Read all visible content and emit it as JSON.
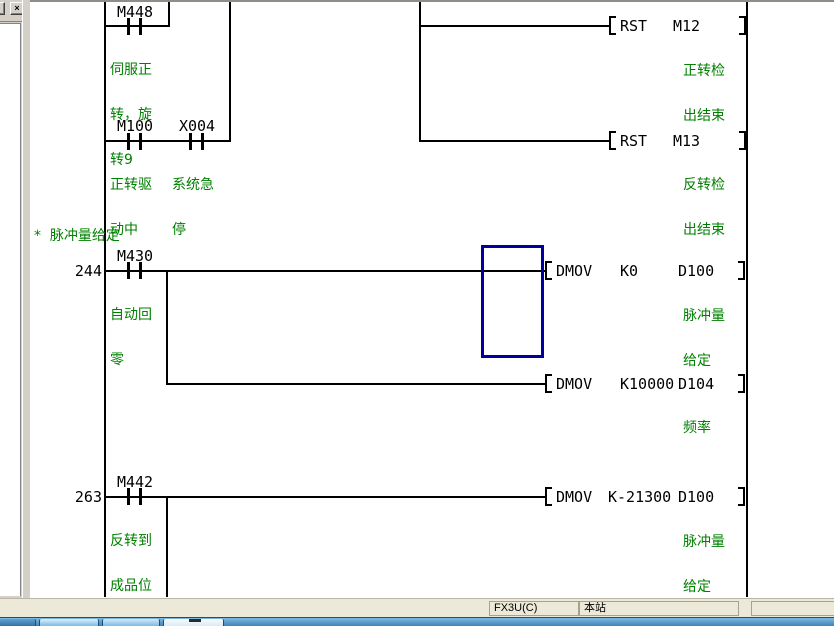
{
  "window": {
    "close_icon": "×"
  },
  "ladder": {
    "comment": "*  脉冲量给定",
    "steps": {
      "rung244": "244",
      "rung263": "263"
    },
    "contacts": {
      "m448": {
        "name": "M448",
        "lines": [
          "伺服正",
          "转，旋",
          "转9"
        ]
      },
      "m100": {
        "name": "M100",
        "lines": [
          "正转驱",
          "动中"
        ]
      },
      "x004": {
        "name": "X004",
        "lines": [
          "系统急",
          "停"
        ]
      },
      "m430": {
        "name": "M430",
        "lines": [
          "自动回",
          "零"
        ]
      },
      "m442": {
        "name": "M442",
        "lines": [
          "反转到",
          "成品位"
        ]
      }
    },
    "instructions": {
      "rst_m12": {
        "mnemonic": "RST",
        "operand": "M12",
        "lines": [
          "正转检",
          "出结束"
        ]
      },
      "rst_m13": {
        "mnemonic": "RST",
        "operand": "M13",
        "lines": [
          "反转检",
          "出结束"
        ]
      },
      "dmov_k0": {
        "mnemonic": "DMOV",
        "source": "K0",
        "dest": "D100",
        "lines": [
          "脉冲量",
          "给定"
        ]
      },
      "dmov_k10000": {
        "mnemonic": "DMOV",
        "source": "K10000",
        "dest": "D104",
        "lines": [
          "频率"
        ]
      },
      "dmov_k21300": {
        "mnemonic": "DMOV",
        "source": "K-21300",
        "dest": "D100",
        "lines": [
          "脉冲量",
          "给定"
        ]
      }
    }
  },
  "status_bar": {
    "plc_type": "FX3U(C)",
    "station": "本站"
  },
  "colors": {
    "wire": "#000000",
    "label_green": "#008000",
    "selection_cursor_blue": "#0000a0",
    "app_chrome_gray": "#d4d0c8",
    "statusbar_gray": "#ece9d8",
    "taskbar_blue": "#4a94cc"
  }
}
